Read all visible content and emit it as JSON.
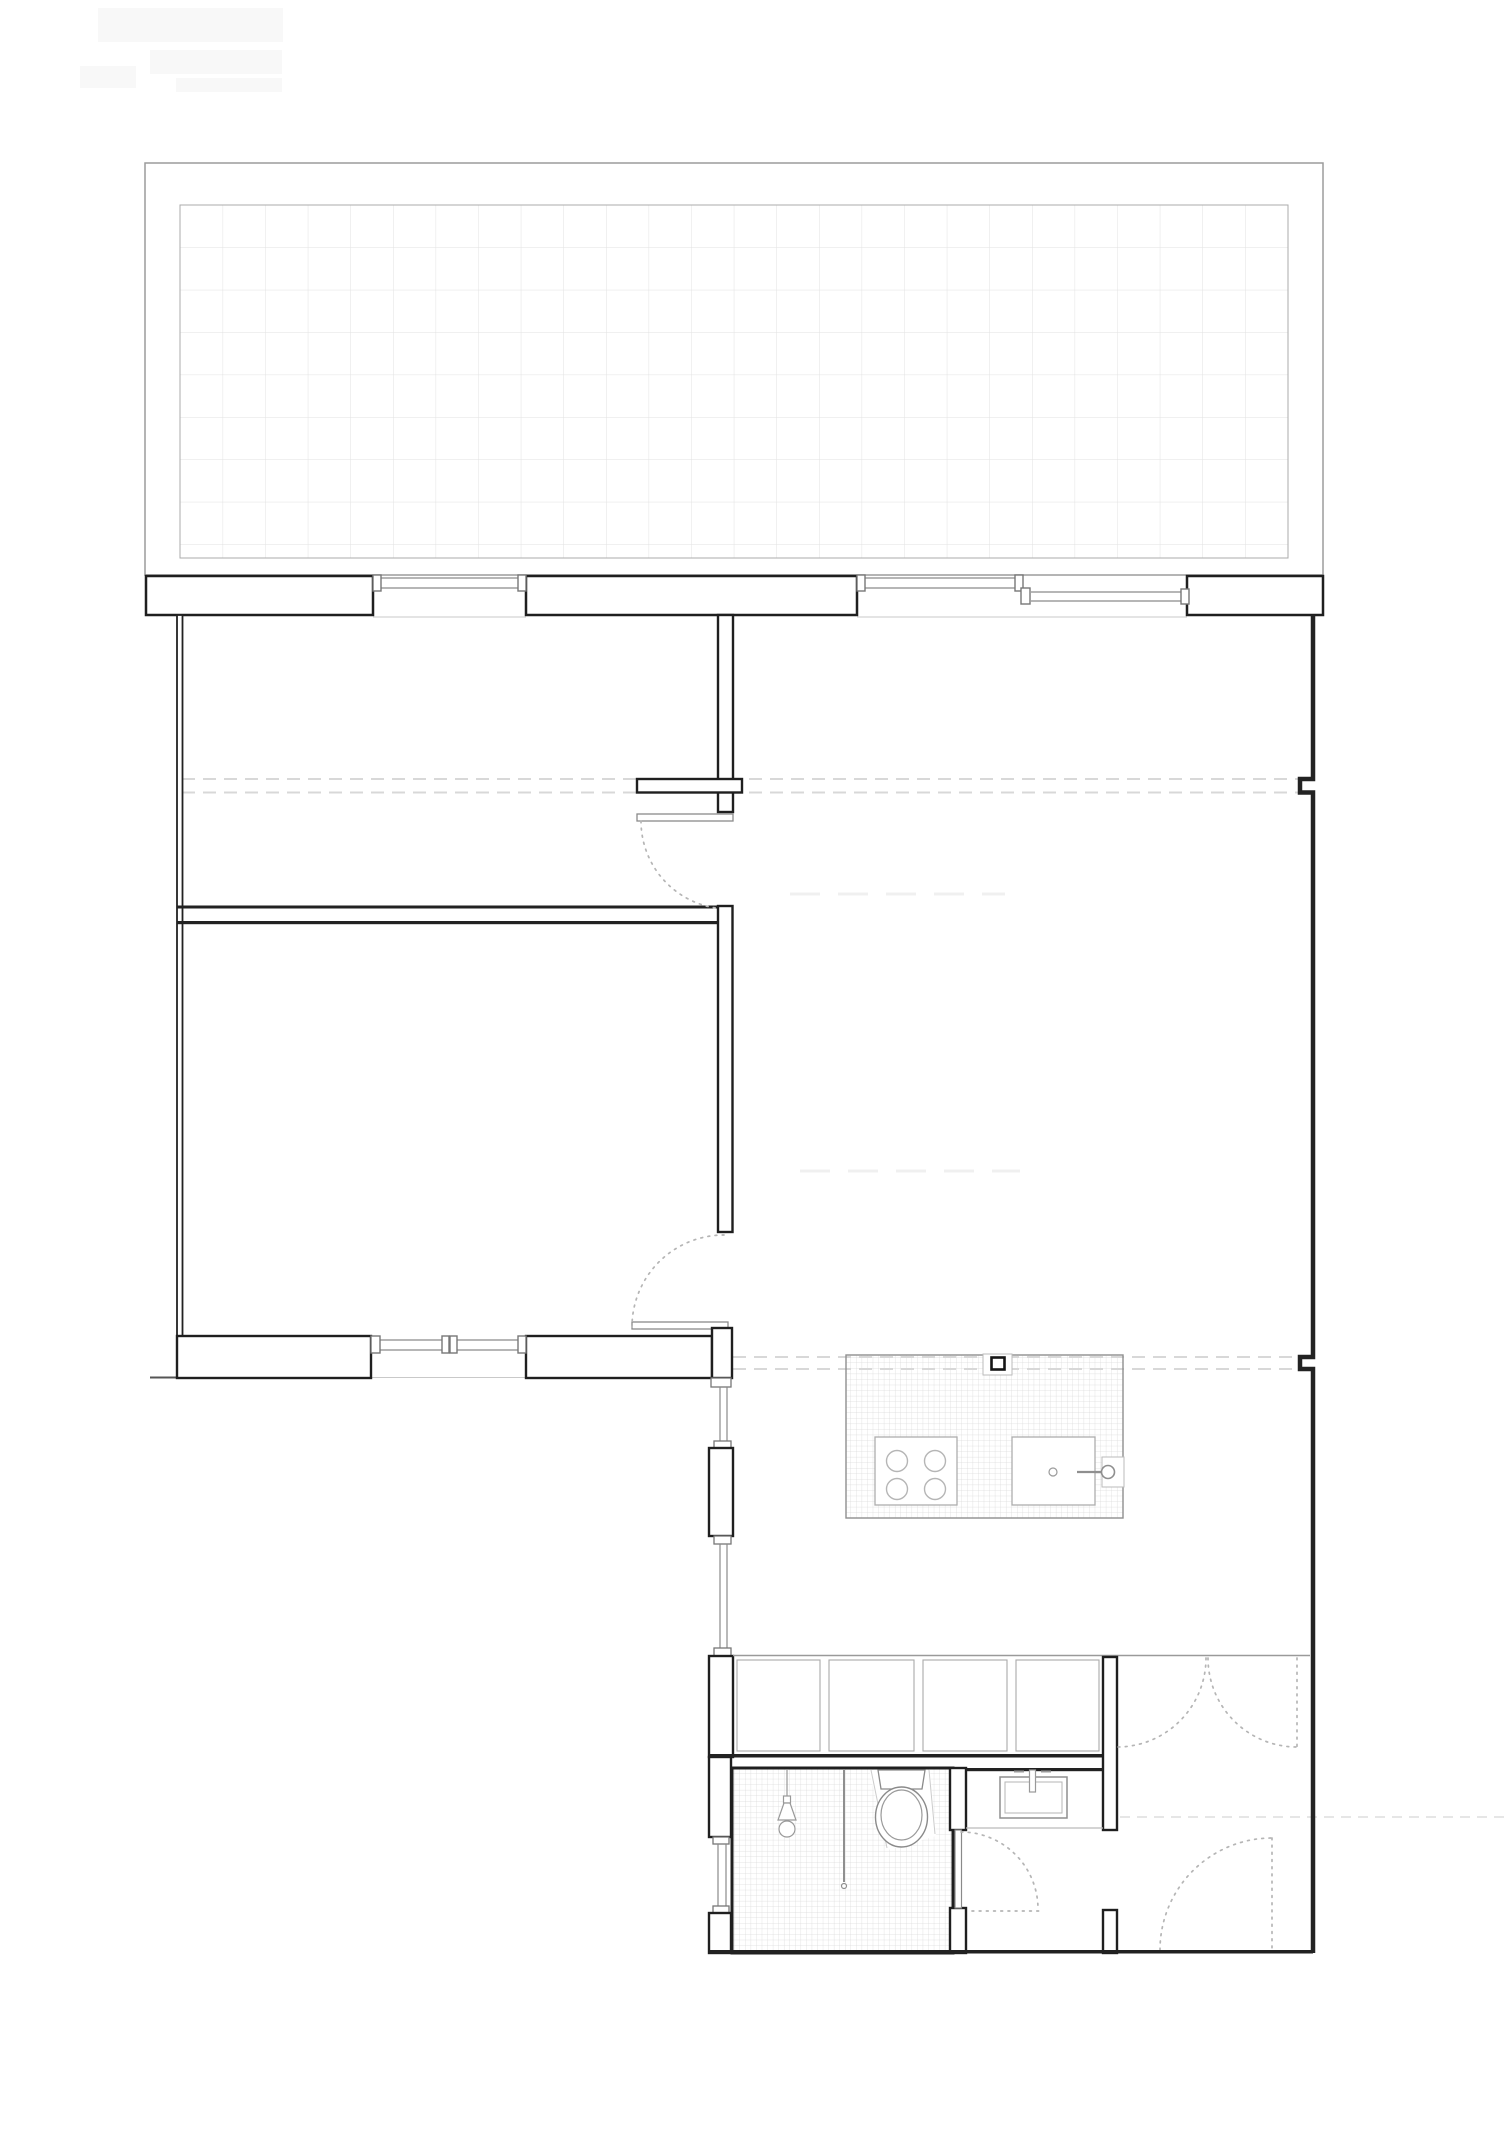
{
  "document": {
    "title": "Apartment floor plan with roof terrace",
    "type": "architectural-floor-plan",
    "visible_text": "none",
    "sheet_size_px": {
      "width": 1512,
      "height": 2138
    }
  },
  "palette": {
    "paper": "#ffffff",
    "wall_dark": "#1f1f1f",
    "wall_fill": "#ffffff",
    "jamb_gray": "#777777",
    "glazing_gray": "#8a8a8a",
    "thin_gray": "#9a9a9a",
    "tile_grid_large": "#e2e2e2",
    "tile_grid_mosaic": "#d9d9d9",
    "dashed_section_line": "#d8d8d8",
    "door_swing_dotted": "#b5b5b5",
    "faint_artifact": "#f8f8f8"
  },
  "plan": {
    "terrace": {
      "outer_rect_px": [
        145,
        163,
        1178,
        412
      ],
      "tile_area_px": [
        180,
        205,
        1108,
        353
      ],
      "tile_size_px": 42.6
    },
    "rooms": [
      {
        "name": "room-1-top-left",
        "approx_px": [
          182,
          615,
          536,
          291
        ]
      },
      {
        "name": "room-2-bottom-left",
        "approx_px": [
          182,
          924,
          536,
          412
        ]
      },
      {
        "name": "living-area",
        "approx_px": [
          733,
          615,
          577,
          1040
        ]
      },
      {
        "name": "bathroom",
        "approx_px": [
          732,
          1768,
          221,
          185
        ],
        "floor": "mosaic-tile"
      },
      {
        "name": "washbasin-niche",
        "approx_px": [
          966,
          1771,
          137,
          57
        ]
      },
      {
        "name": "entry-hall",
        "approx_px": [
          1117,
          1657,
          196,
          296
        ]
      }
    ],
    "windows": [
      {
        "name": "terrace-window-1",
        "span_px": [
          381,
          518
        ],
        "sill_y": 577
      },
      {
        "name": "terrace-window-2",
        "span_px": [
          865,
          1015
        ],
        "sill_y": 577
      },
      {
        "name": "terrace-window-3",
        "span_px": [
          1031,
          1181
        ],
        "sill_y": 591
      },
      {
        "name": "room2-south-window",
        "span_px": [
          380,
          518
        ],
        "sill_y": 1339,
        "mullion_x": 446
      },
      {
        "name": "west-corridor-glazing-1",
        "span_y": [
          1387,
          1441
        ],
        "x": 723
      },
      {
        "name": "west-corridor-glazing-2",
        "span_y": [
          1544,
          1648
        ],
        "x": 723
      },
      {
        "name": "west-bath-glazing",
        "span_y": [
          1844,
          1906
        ],
        "x": 722
      }
    ],
    "doors": [
      {
        "name": "room-1-door",
        "leaf_px": [
          637,
          814,
          96,
          7
        ],
        "swing": "quarter-arc-dotted"
      },
      {
        "name": "room-2-door",
        "leaf_px": [
          632,
          1322,
          96,
          7
        ],
        "swing": "quarter-arc-dotted"
      },
      {
        "name": "bathroom-door",
        "leaf_px": [
          955,
          1830,
          6,
          78
        ],
        "swing": "quarter-arc-dotted"
      },
      {
        "name": "hall-double-door",
        "opening_px": [
          1117,
          1313
        ],
        "swing": "two-leaf-dotted"
      },
      {
        "name": "entry-door",
        "hinge_px": [
          1272,
          1950
        ],
        "radius_px": 112,
        "swing": "quarter-arc-dotted"
      }
    ],
    "fixtures": {
      "kitchen_island": {
        "rect_px": [
          846,
          1355,
          277,
          163
        ],
        "finish": "mosaic-tile",
        "column_px": [
          991,
          1357,
          13,
          12
        ],
        "stove": {
          "rect_px": [
            875,
            1437,
            82,
            68
          ],
          "burners": 4,
          "burner_r_px": 10.5
        },
        "sink": {
          "rect_px": [
            1012,
            1437,
            83,
            68
          ],
          "drain_r_px": 4,
          "faucet_circle_r_px": 6.5
        }
      },
      "bathroom": {
        "pendant_lamp_center_px": [
          787,
          1829
        ],
        "shower_screen_line_x": 844,
        "toilet_center_px": [
          901,
          1817
        ]
      },
      "washbasin": {
        "outer_rect_px": [
          1000,
          1777,
          67,
          41
        ]
      },
      "closet_row": {
        "rect_px": [
          733,
          1656,
          370,
          100
        ],
        "compartments": 4,
        "divider_xs_px": [
          825,
          919,
          1012
        ]
      }
    },
    "section_lines": [
      {
        "name": "upper-dashed-pair",
        "y_px": [
          779,
          792
        ],
        "span_px": [
          182,
          1300
        ]
      },
      {
        "name": "lower-dashed-pair",
        "y_px": [
          1357,
          1369
        ],
        "span_px": [
          733,
          1300
        ]
      },
      {
        "name": "entry-dashed-line",
        "y_px": [
          1817
        ],
        "span_px": [
          1120,
          1505
        ]
      }
    ]
  }
}
